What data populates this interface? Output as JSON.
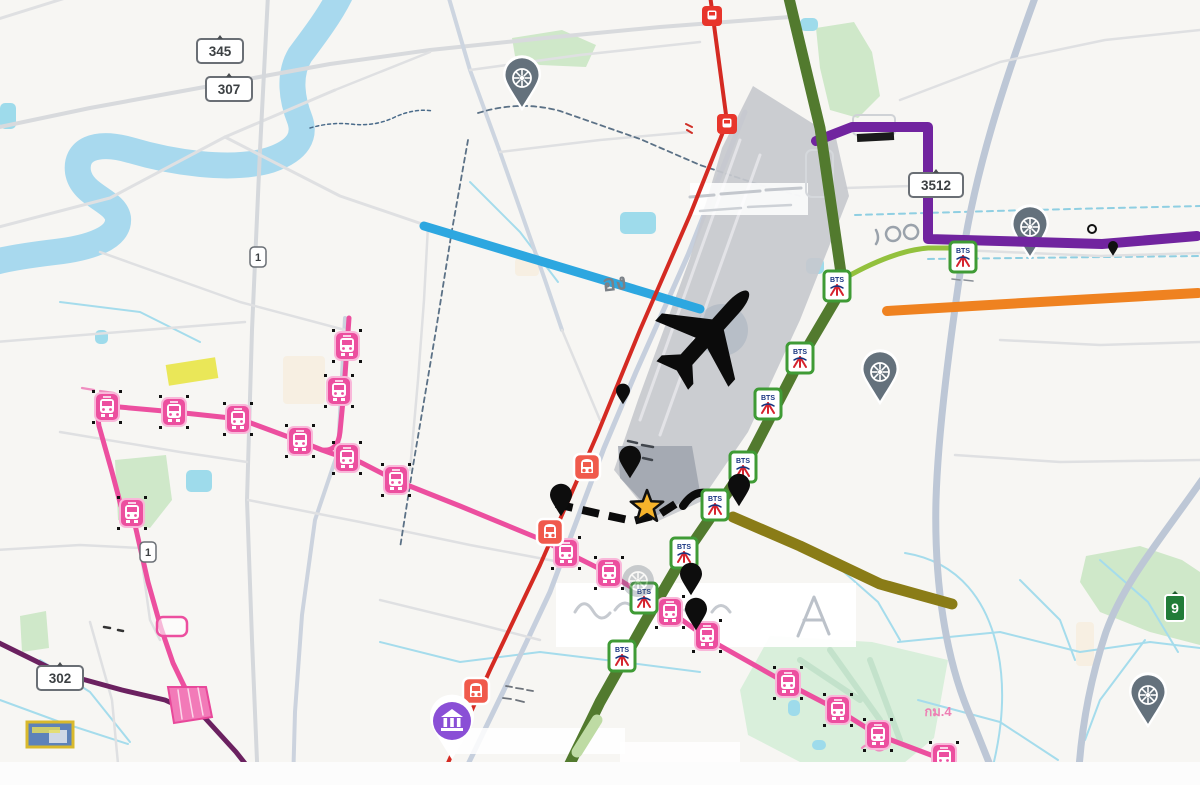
{
  "map": {
    "palette": {
      "bg": "#f7f6f3",
      "park": "#cfe8c9",
      "park_mint": "#d9efdb",
      "water": "#a8d9ee",
      "pond": "#9edbeb",
      "canal": "#a5dcec",
      "road": "#dfe0e2",
      "road_major": "#c6cfdd",
      "airport_fill": "#c7c9ce",
      "airport_dark": "#9ba1ab",
      "orange_route": "#ef8220",
      "blue_route": "#2da7e0",
      "olive_route": "#8a7c17",
      "purple_route": "#71249f",
      "dark_purple_route": "#6b2160",
      "green_line": "#527a2e",
      "light_green_branch": "#93c13d",
      "red_line": "#d42a22",
      "pink_line": "#ec4f9f",
      "black_route": "#0b0b0b",
      "star_fill": "#f6b32b",
      "temple_pin": "#64717c",
      "mrt_pin": "#8a4fd6",
      "red_station": "#f05a4c",
      "red_square": "#e8352b",
      "bts_border": "#3f9b35",
      "bts_blue": "#16337f",
      "bts_red": "#d6232e"
    },
    "bts_logo_text": "BTS",
    "shields": [
      {
        "label": "345",
        "x": 220,
        "y": 51,
        "w": 46,
        "h": 24,
        "style": "white"
      },
      {
        "label": "307",
        "x": 229,
        "y": 89,
        "w": 46,
        "h": 24,
        "style": "white"
      },
      {
        "label": "302",
        "x": 60,
        "y": 678,
        "w": 46,
        "h": 24,
        "style": "white"
      },
      {
        "label": "3512",
        "x": 936,
        "y": 185,
        "w": 54,
        "h": 24,
        "style": "white"
      },
      {
        "label": "1",
        "x": 258,
        "y": 257,
        "w": 16,
        "h": 20,
        "style": "white-sm"
      },
      {
        "label": "1",
        "x": 148,
        "y": 552,
        "w": 16,
        "h": 20,
        "style": "white-sm"
      },
      {
        "label": "9",
        "x": 1175,
        "y": 608,
        "w": 20,
        "h": 26,
        "style": "green"
      }
    ],
    "texts": [
      {
        "label": "กม.4",
        "x": 938,
        "y": 716,
        "size": 13,
        "color": "#ee7fb4",
        "rot": 0
      },
      {
        "label": "อง",
        "x": 615,
        "y": 290,
        "size": 22,
        "color": "#7b8187",
        "rot": -6
      }
    ],
    "parks": [
      {
        "pts": "512,38 562,30 596,45 586,67 540,65 515,56",
        "fill": "park"
      },
      {
        "pts": "816,28 854,22 872,52 880,96 858,118 830,110 820,68",
        "fill": "park"
      },
      {
        "pts": "1086,556 1140,546 1182,560 1200,572 1200,645 1150,632 1100,612 1080,582",
        "fill": "park"
      },
      {
        "pts": "770,636 872,642 948,660 934,738 898,768 800,762 748,735 740,690",
        "fill": "park_mint"
      },
      {
        "pts": "115,460 166,455 172,500 150,528 118,520",
        "fill": "park"
      },
      {
        "pts": "20,616 46,611 49,648 22,652",
        "fill": "park"
      }
    ],
    "park_streaks": {
      "d": "M800,660 L860,700 M830,650 L880,720 M870,660 L900,740",
      "c": "#b9ddc4",
      "w": 6
    },
    "cream_patches": [
      {
        "x": 283,
        "y": 356,
        "w": 42,
        "h": 48
      },
      {
        "x": 515,
        "y": 258,
        "w": 24,
        "h": 18
      },
      {
        "x": 1076,
        "y": 622,
        "w": 18,
        "h": 44
      }
    ],
    "river": {
      "d": "M340,-5 C330,15 315,35 300,55 C288,75 292,100 300,120 C305,135 300,150 270,160 C230,172 170,162 130,150 C95,140 75,150 78,172 C82,196 115,200 118,218 C120,238 90,248 55,252 C30,255 10,258 -5,262",
      "w": 26
    },
    "river_squiggle": {
      "d": "M310,128 q20,-6 40,-4 q25,3 45,-7 q20,-9 38,-6",
      "c": "#4a6b8a",
      "w": 1.5,
      "dash": "3,3"
    },
    "ponds": [
      {
        "x": 620,
        "y": 212,
        "w": 36,
        "h": 22
      },
      {
        "x": 186,
        "y": 470,
        "w": 26,
        "h": 22
      },
      {
        "x": 95,
        "y": 330,
        "w": 13,
        "h": 14
      },
      {
        "x": 806,
        "y": 258,
        "w": 18,
        "h": 16
      },
      {
        "x": 800,
        "y": 18,
        "w": 18,
        "h": 13
      },
      {
        "x": 0,
        "y": 103,
        "w": 16,
        "h": 26
      },
      {
        "x": 788,
        "y": 700,
        "w": 12,
        "h": 16
      },
      {
        "x": 812,
        "y": 740,
        "w": 14,
        "h": 10
      }
    ],
    "canals": [
      "M905,553 C960,562 988,602 998,652 C1008,702 998,750 988,785",
      "M898,642 L1000,632 L1080,652 L1150,642 L1200,648",
      "M918,700 L1000,722 L1058,760",
      "M1100,560 L1148,602 L1178,652",
      "M1145,640 L1100,700 L1085,740",
      "M380,642 L460,662 L540,652 L622,662",
      "M622,662 L700,672",
      "M60,302 L140,312 L200,342",
      "M470,182 L520,232 L558,282",
      "M40,660 L90,692 L130,742",
      "M0,700 L60,722 L128,744",
      "M1020,580 L1060,620 L1075,660",
      "M828,558 L878,602 L900,640"
    ],
    "canals_dashed": [
      "M855,215 L1030,210 L1200,206",
      "M928,259 L1200,256"
    ],
    "roads": [
      {
        "d": "M-5,20 L75,-5",
        "w": 3
      },
      {
        "d": "M-5,128 L90,108 L210,86 L330,64 L430,50 L545,38 L660,27 L790,17",
        "w": 4,
        "c": "#d8dadd"
      },
      {
        "d": "M-5,228 L110,198 L225,137 L335,90",
        "w": 3
      },
      {
        "d": "M268,-5 L260,150 L252,330 L247,500 L252,640 L258,785",
        "w": 4,
        "c": "#d5d8dc"
      },
      {
        "d": "M225,137 L340,196 L428,226",
        "w": 3
      },
      {
        "d": "M448,-5 L470,70 L500,152 L545,280 L562,330",
        "w": 4,
        "c": "#cdd5e0"
      },
      {
        "d": "M345,318 L338,452 L315,520 L302,615 L295,712 L293,785",
        "w": 4,
        "c": "#ccd3de"
      },
      {
        "d": "M745,112 L688,255 L636,372 L604,448 L550,592 L503,692 L458,785",
        "w": 5,
        "c": "#c6cfdd"
      },
      {
        "d": "M1036,-5 C1005,80 975,170 962,260 C950,340 938,430 936,500 C934,580 945,660 972,720 L998,785",
        "w": 7,
        "c": "#bdc7d6"
      },
      {
        "d": "M1202,480 C1160,540 1124,582 1106,632 C1088,686 1080,740 1078,785",
        "w": 7,
        "c": "#bdc7d6"
      },
      {
        "d": "M900,100 L1000,62 L1105,40 L1200,30",
        "w": 2.5
      },
      {
        "d": "M960,250 L1100,256 L1200,253",
        "w": 2.5
      },
      {
        "d": "M100,252 L240,302 L345,330",
        "w": 2.5
      },
      {
        "d": "M-5,342 L120,332 L245,322",
        "w": 2.5
      },
      {
        "d": "M60,432 L180,452 L247,462",
        "w": 2.5
      },
      {
        "d": "M248,500 L360,522 L470,545 L560,562",
        "w": 2.5
      },
      {
        "d": "M380,600 L470,622 L540,640",
        "w": 2.5
      },
      {
        "d": "M90,622 L112,700 L120,785",
        "w": 2.5
      },
      {
        "d": "M562,330 L600,420",
        "w": 2.5
      },
      {
        "d": "M845,188 L912,186",
        "w": 2.5
      },
      {
        "d": "M335,90 L430,52",
        "w": 2.5
      },
      {
        "d": "M470,70 L580,55 L700,42",
        "w": 2.5
      },
      {
        "d": "M500,152 L600,140 L690,132",
        "w": 2.5
      },
      {
        "d": "M428,226 L424,300 L418,380 L410,470",
        "w": 2.5
      },
      {
        "d": "M-5,550 L80,545 L140,548",
        "w": 2.5
      },
      {
        "d": "M140,548 L150,620 L160,640",
        "w": 2.5
      },
      {
        "d": "M1000,340 L1100,345 L1200,342",
        "w": 2.5
      },
      {
        "d": "M955,455 L1060,462 L1200,460",
        "w": 2.5
      }
    ],
    "boundaries": [
      {
        "d": "M478,113 Q520,100 560,111 L640,139 L700,165 L760,185 L800,196"
      },
      {
        "d": "M468,140 L452,230 L436,330 L412,472 L400,548"
      }
    ],
    "airport": {
      "outline": "M753,86 L836,138 L849,196 L800,320 L748,432 L700,502 L656,522 L614,470 L638,400 L690,258 L722,148 Z",
      "inner": "M618,446 L692,446 L700,492 L656,516 L620,478 Z",
      "runways": [
        "M740,140 L640,420",
        "M760,155 L660,435"
      ],
      "circle": {
        "cx": 722,
        "cy": 330,
        "r": 26
      }
    },
    "white_patches": [
      {
        "x": 556,
        "y": 583,
        "w": 300,
        "h": 64,
        "o": 0.93
      },
      {
        "x": 690,
        "y": 183,
        "w": 118,
        "h": 32,
        "o": 0.85
      },
      {
        "x": 620,
        "y": 742,
        "w": 120,
        "h": 20,
        "o": 0.8
      },
      {
        "x": 455,
        "y": 728,
        "w": 170,
        "h": 26,
        "o": 0.85
      }
    ],
    "ghosts": [
      {
        "d": "M690,197 L714,195 M721,194 L760,191 M766,190 L801,188",
        "c": "#c3c7cd",
        "w": 3
      },
      {
        "d": "M700,211 L741,208 M748,207 L791,205",
        "c": "#cdd1d6",
        "w": 2.5
      },
      {
        "d": "M628,441 l9,2 m5,2 l11,2 m-22,8 l7,2 m5,1 l9,2",
        "c": "#41464d",
        "w": 2.5
      },
      {
        "d": "M893,227 a7,7 0 1 0 0.1,0 M911,225 a7,7 0 1 0 0.1,0 M876,230 q4,8 0,14",
        "c": "#9aa2ab",
        "w": 2.5
      },
      {
        "d": "M575,612 q9,-16 18,-1 q8,13 17,2 M615,610 q10,-14 20,0 M645,612 q8,-12 16,0 q8,12 16,1 M685,610 q10,-12 20,1 M712,612 q9,-13 18,0",
        "c": "#c6cad0",
        "w": 3
      },
      {
        "d": "M798,636 L814,597 L829,634 M804,620 L823,620",
        "c": "#bcc2ca",
        "w": 3
      },
      {
        "d": "M506,686 l6,1 m4,1 l7,1 m4,1 l6,1 m-30,7 l8,1 m5,1 l8,2",
        "c": "#6d737b",
        "w": 1.8
      },
      {
        "d": "M82,388 l12,2 m6,1 l14,2 M862,748 q6,-6 12,0 q5,5 11,0",
        "c": "#ef8ec0",
        "w": 2.2
      },
      {
        "d": "M104,627 l6,1 m8,2 l5,1",
        "c": "#333333",
        "w": 2.5
      },
      {
        "d": "M686,124 l6,3 m-5,3 l5,3",
        "c": "#d03028",
        "w": 2
      },
      {
        "d": "M952,279 l8,1 m4,0 l9,1",
        "c": "#8a9098",
        "w": 1.6
      }
    ],
    "transit_lines": [
      {
        "name": "orange-route",
        "color_key": "orange_route",
        "w": 10,
        "d": "M887,311 L1040,302 L1198,293"
      },
      {
        "name": "blue-route",
        "color_key": "blue_route",
        "w": 9,
        "d": "M424,226 L700,309"
      },
      {
        "name": "olive-route",
        "color_key": "olive_route",
        "w": 11,
        "d": "M733,517 L800,546 L880,584 L952,604"
      },
      {
        "name": "dark-purple-route",
        "color_key": "dark_purple_route",
        "w": 5,
        "d": "M-5,641 L60,673 L122,690 L165,700 L205,718 L236,752 L262,785"
      },
      {
        "name": "purple-route",
        "color_key": "purple_route",
        "w": 10,
        "d": "M816,141 L852,127 L928,127 L928,239 L1102,244 L1197,236"
      },
      {
        "name": "light-green-branch",
        "color_key": "light_green_branch",
        "w": 5,
        "d": "M838,282 C872,262 902,250 928,248 L962,248"
      },
      {
        "name": "bts-green-line",
        "color_key": "green_line",
        "w": 11,
        "d": "M788,-6 L820,128 L843,287 L800,360 L743,470 L680,562 L645,622 L600,702 L563,778"
      },
      {
        "name": "bts-green-line-light-segment",
        "color_key": "",
        "color": "#bedba4",
        "w": 11,
        "d": "M597,720 L577,752"
      },
      {
        "name": "srt-red-line",
        "color_key": "red_line",
        "w": 4,
        "d": "M710,-5 L727,122 L690,215 L640,330 L597,435 L540,565 L490,670 L438,785"
      },
      {
        "name": "mrt-pink-line-spur",
        "color_key": "pink_line",
        "w": 5,
        "d": "M349,318 L344,390 L340,432 Q338,452 322,450"
      },
      {
        "name": "mrt-pink-line-main",
        "color_key": "pink_line",
        "w": 5,
        "d": "M108,406 L175,412 L240,419 L302,442 L322,450 Q341,457 360,462 L397,481 L460,506 L540,539 L610,574 L668,610 L710,640 L788,684 L838,710 L878,735 L944,760 L986,785"
      },
      {
        "name": "mrt-pink-line-branch",
        "color_key": "pink_line",
        "w": 5,
        "d": "M108,406 Q96,411 99,426 L112,472 L121,506 L133,516 L148,582 L161,628 L173,663 L186,690"
      }
    ],
    "pink_depot": {
      "pts": "168,687 206,687 212,717 174,723",
      "hatch": "M178,690 L182,719 M188,689 L193,717 M198,688 L203,715"
    },
    "pink_outline_box": {
      "x": 157,
      "y": 617,
      "w": 30,
      "h": 19
    },
    "route_dashed": {
      "d": "M556,504 L600,514 L633,521 L660,514 L677,503",
      "w": 8,
      "dash": "17,10"
    },
    "route_arc": {
      "d": "M683,506 Q697,485 716,497",
      "w": 8
    },
    "pink_stations": [
      [
        107,
        407
      ],
      [
        174,
        412
      ],
      [
        238,
        419
      ],
      [
        300,
        441
      ],
      [
        347,
        458
      ],
      [
        396,
        480
      ],
      [
        347,
        346
      ],
      [
        339,
        391
      ],
      [
        132,
        513
      ],
      [
        566,
        553
      ],
      [
        609,
        573
      ],
      [
        670,
        612
      ],
      [
        707,
        636
      ],
      [
        788,
        683
      ],
      [
        838,
        710
      ],
      [
        878,
        735
      ],
      [
        944,
        758
      ]
    ],
    "red_stations": [
      [
        587,
        467
      ],
      [
        550,
        532
      ],
      [
        476,
        691
      ]
    ],
    "red_squares": [
      [
        712,
        16
      ],
      [
        727,
        124
      ]
    ],
    "bts_stations": [
      [
        837,
        286
      ],
      [
        800,
        358
      ],
      [
        768,
        404
      ],
      [
        743,
        467
      ],
      [
        715,
        505
      ],
      [
        684,
        553
      ],
      [
        644,
        598
      ],
      [
        622,
        656
      ],
      [
        963,
        257
      ]
    ],
    "temple_pins": [
      [
        522,
        78
      ],
      [
        880,
        372
      ],
      [
        1030,
        227
      ],
      [
        1148,
        695
      ]
    ],
    "temple_faded": [
      638,
      581
    ],
    "black_pins": [
      [
        561,
        497
      ],
      [
        630,
        459
      ],
      [
        739,
        487
      ],
      [
        691,
        576
      ],
      [
        696,
        611
      ]
    ],
    "black_pin_small": [
      623,
      392
    ],
    "tiny_marks": {
      "ring": [
        1092,
        229
      ],
      "mini_pin": [
        1113,
        247
      ]
    },
    "mrt_pin": {
      "x": 452,
      "y": 721
    },
    "star": {
      "cx": 647,
      "cy": 507,
      "R": 17,
      "r": 7.2
    },
    "plane": {
      "x": 706,
      "y": 338,
      "rot": 42,
      "scale": 1.12
    },
    "black_bar": {
      "x": 857,
      "y": 133,
      "w": 37,
      "h": 8,
      "rot": -3
    },
    "white_box": {
      "x": 853,
      "y": 115,
      "w": 42,
      "h": 20
    },
    "building_box": {
      "x": 806,
      "y": 150,
      "w": 27,
      "h": 47
    },
    "yellow_road": {
      "x": 167,
      "y": 361,
      "w": 50,
      "h": 21,
      "rot": -9,
      "fill": "#e7e43c"
    },
    "legend_box": {
      "x": 27,
      "y": 722,
      "w": 46,
      "h": 25,
      "border": "#d9b92c",
      "fill": "#5d82b9",
      "inner": "#cfd8e6"
    },
    "bottom_band": {
      "y": 762,
      "h": 23
    }
  }
}
